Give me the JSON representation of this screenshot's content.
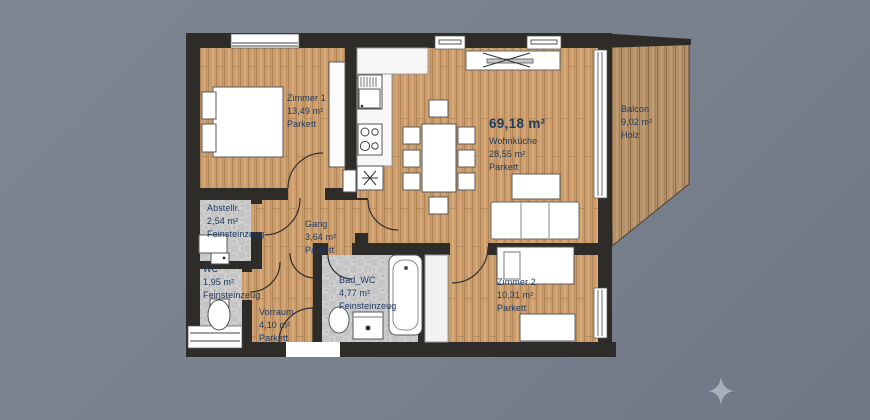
{
  "total_area": "69,18 m²",
  "rooms": [
    {
      "id": "zimmer-1",
      "name": "Zimmer 1",
      "area": "13,49 m²",
      "floor": "Parkett"
    },
    {
      "id": "wohnkueche",
      "name": "Wohnküche",
      "area": "28,55 m²",
      "floor": "Parkett"
    },
    {
      "id": "balcon",
      "name": "Balcon",
      "area": "9,02 m²",
      "floor": "Holz"
    },
    {
      "id": "abstellraum",
      "name": "Abstellr.",
      "area": "2,54 m²",
      "floor": "Feinsteinzeug"
    },
    {
      "id": "gang",
      "name": "Gang",
      "area": "3,64 m²",
      "floor": "Parkett"
    },
    {
      "id": "wc",
      "name": "WC",
      "area": "1,95 m²",
      "floor": "Feinsteinzeug"
    },
    {
      "id": "vorraum",
      "name": "Vorraum",
      "area": "4,10 m²",
      "floor": "Parkett"
    },
    {
      "id": "bad-wc",
      "name": "Bad_WC",
      "area": "4,77 m²",
      "floor": "Feinsteinzeug"
    },
    {
      "id": "zimmer-2",
      "name": "Zimmer 2",
      "area": "10,31 m²",
      "floor": "Parkett"
    }
  ],
  "palette": {
    "background": "#79818f",
    "wall": "#2e2c29",
    "wood_floor": "#ca9c6b",
    "balcony_wood": "#b6926a",
    "tile_floor": "#cccccc",
    "label_text": "#1d3a63",
    "furniture": "#ffffff",
    "compass_star": "#a9afba"
  },
  "icons": {
    "compass_star": "four-pointed-star"
  }
}
